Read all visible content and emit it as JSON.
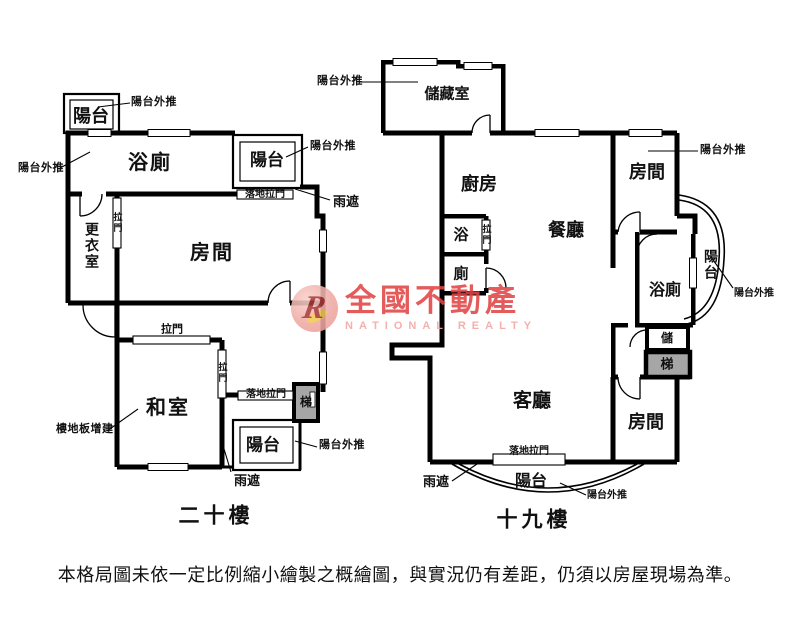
{
  "floor20": {
    "title": "二十樓",
    "rooms": {
      "bathroom": "浴廁",
      "dressing_room": "更衣室",
      "bedroom": "房間",
      "tatami_room": "和室"
    },
    "note_floor_slab_addition": "樓地板增建"
  },
  "floor19": {
    "title": "十九樓",
    "rooms": {
      "storage_room": "儲藏室",
      "kitchen": "廚房",
      "bath": "浴",
      "toilet": "廁",
      "dining_room": "餐廳",
      "bedroom_upper": "房間",
      "bathroom": "浴廁",
      "closet": "儲",
      "living_room": "客廳",
      "bedroom_lower": "房間"
    }
  },
  "terms": {
    "balcony": "陽台",
    "balcony_pushed_out": "陽台外推",
    "rain_cover": "雨遮",
    "sliding_door": "拉門",
    "floor_sliding_door": "落地拉門",
    "stairs": "梯"
  },
  "watermark": {
    "brand": "全國不動產",
    "subtitle": "NATIONAL REALTY",
    "logo_letter": "R"
  },
  "disclaimer": "本格局圖未依一定比例縮小繪製之概繪圖，與實況仍有差距，仍須以房屋現場為準。",
  "colors": {
    "wall": "#000000",
    "stair_fill": "#a6a6a6",
    "brand_red": "#e24545",
    "brand_pink": "#f2a6a2"
  }
}
